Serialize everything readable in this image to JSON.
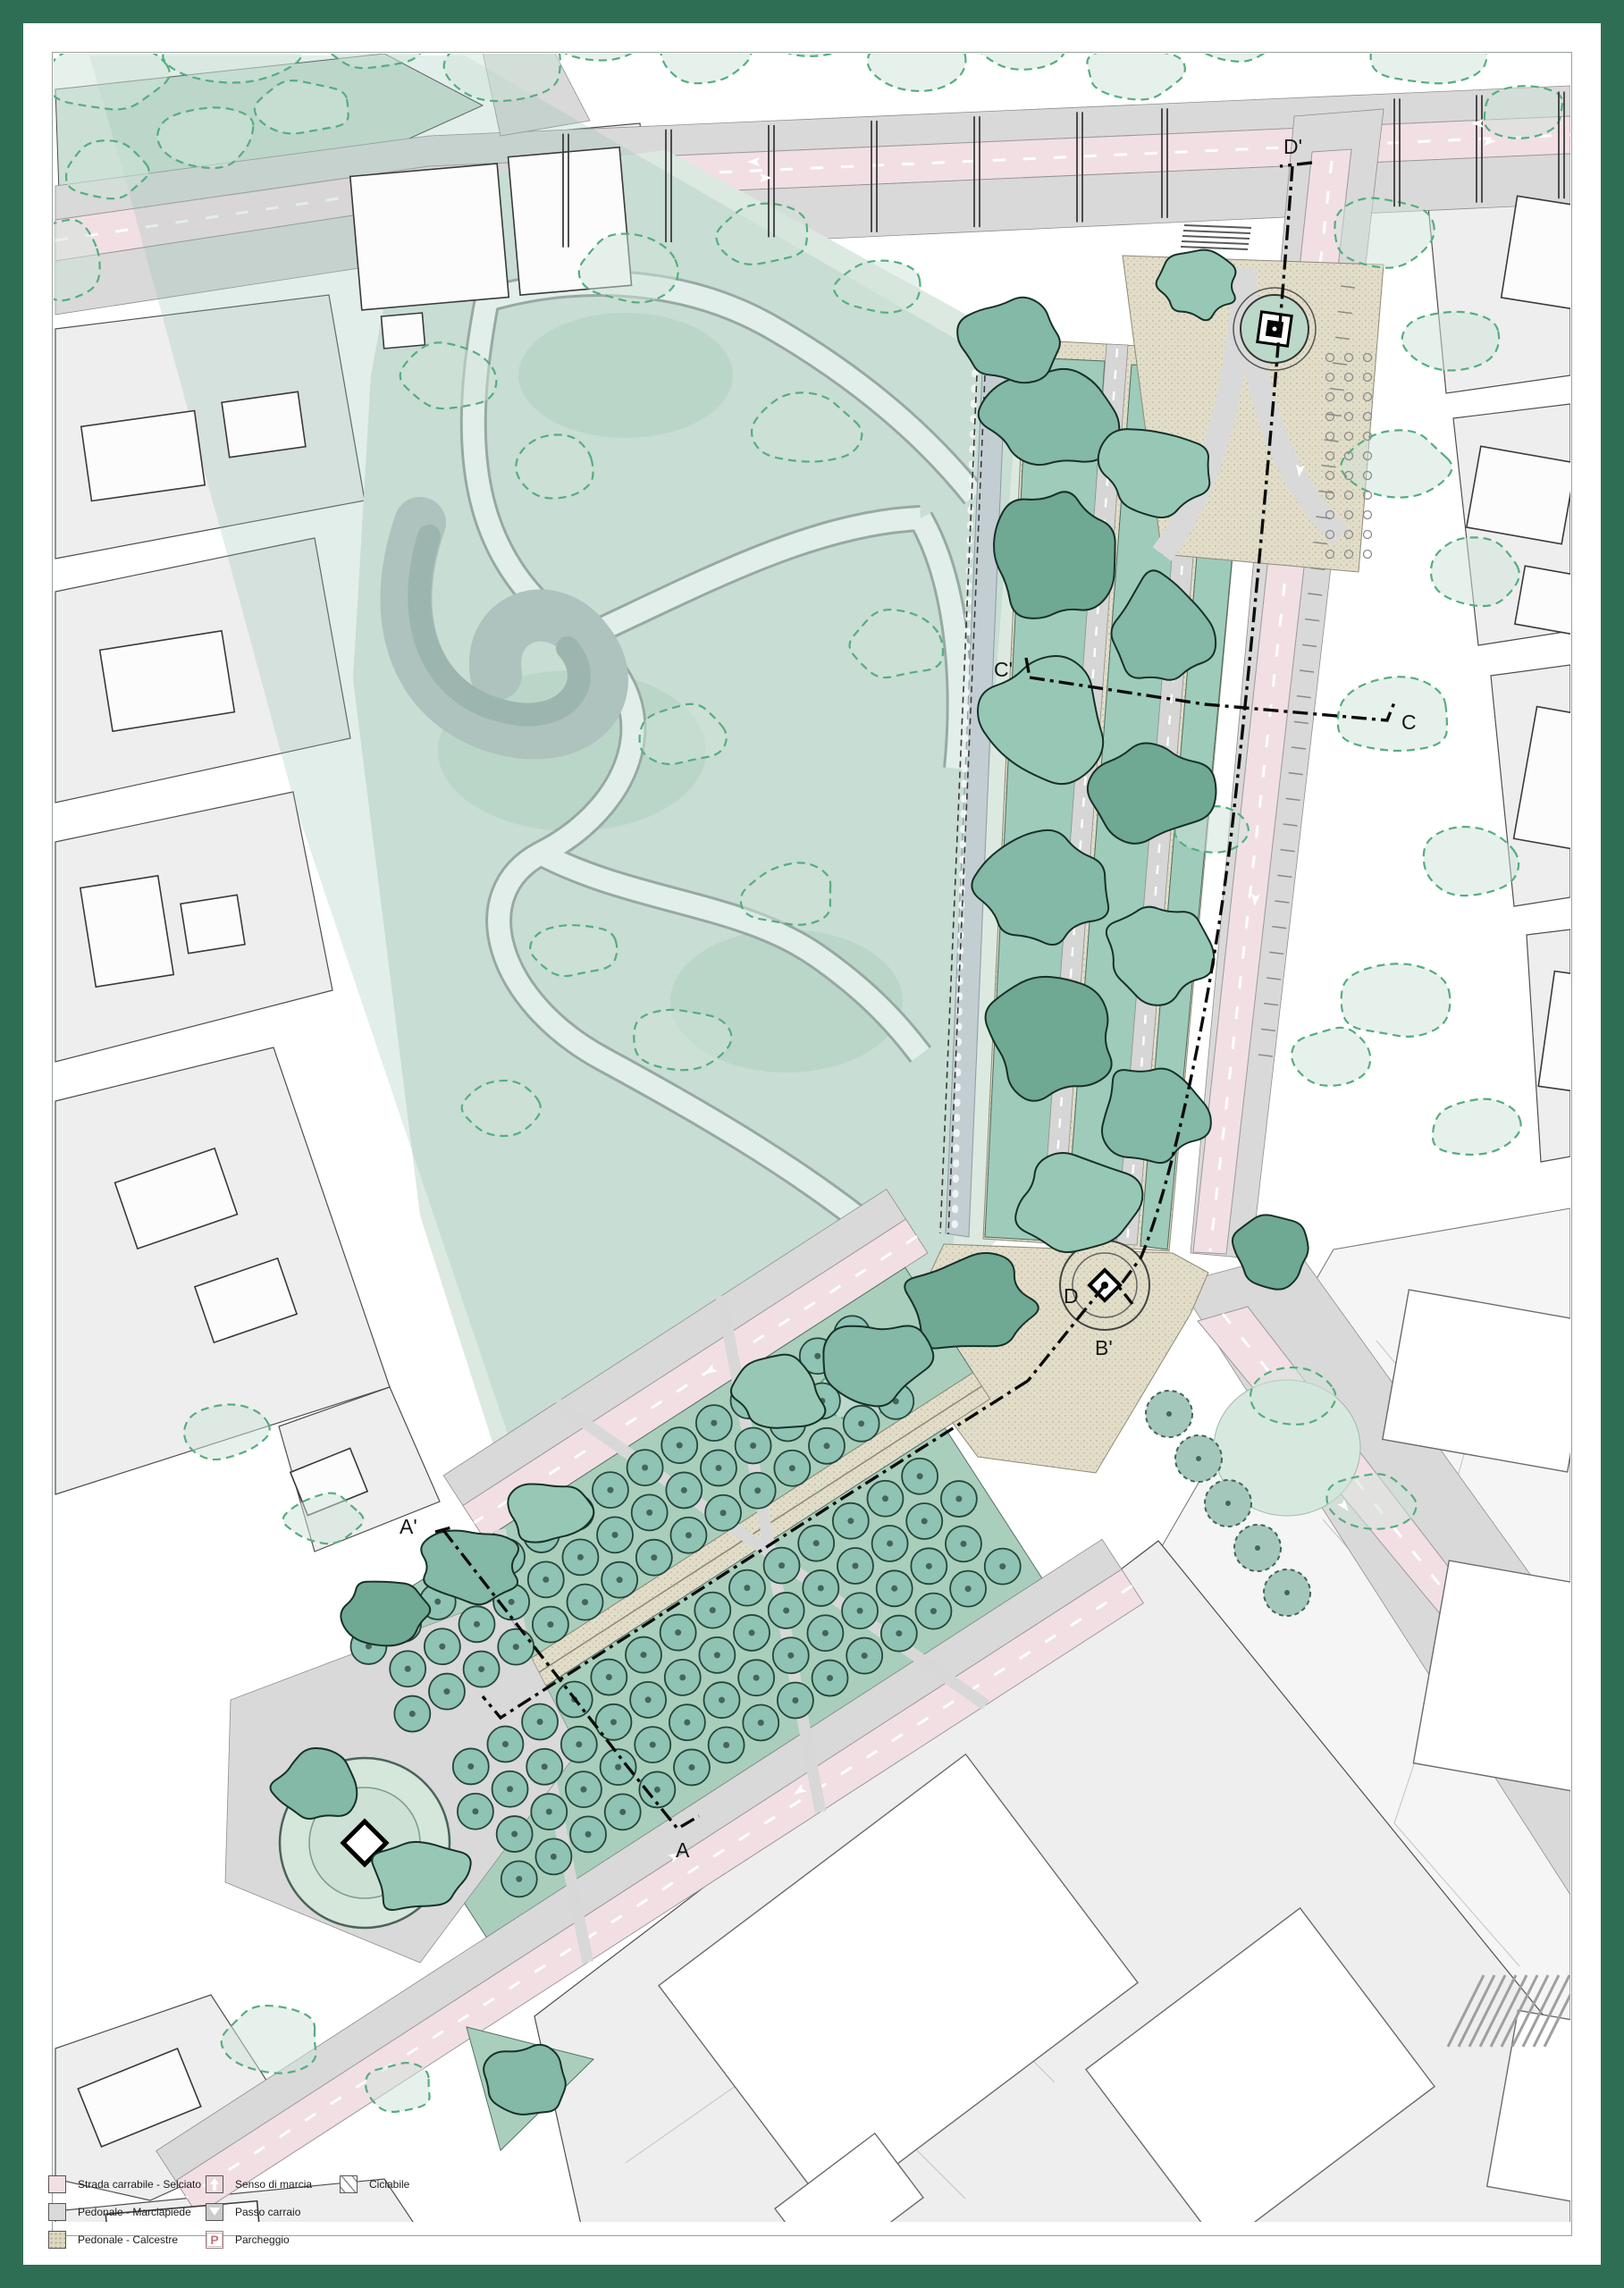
{
  "palette": {
    "border_green": "#2e6e55",
    "road_pink": "#f2dfe4",
    "sidewalk_gray": "#d9d9d9",
    "calcestre": "#e2ddc9",
    "lawn_green": "#a9cfbc",
    "park_fill": "#dce9e1",
    "canopy_dark": "#6fa893",
    "canopy_mid": "#83b9a6",
    "canopy_light": "#97c8b6",
    "existing_tree_fill": "#cfe4d9",
    "existing_tree_stroke": "#54ae7e",
    "water_gray": "#b9c4c4",
    "block_gray": "#eeeeee",
    "parking_letter": "#c0737f"
  },
  "legend": {
    "items": [
      {
        "label": "Strada carrabile - Selciato",
        "swatch": "road-pink"
      },
      {
        "label": "Pedonale - Marciapiede",
        "swatch": "sidewalk-gray"
      },
      {
        "label": "Pedonale - Calcestre",
        "swatch": "calcestre-beige"
      },
      {
        "label": "Senso di marcia",
        "swatch": "direction-arrow",
        "icon": "up-arrow"
      },
      {
        "label": "Passo carraio",
        "swatch": "driveway-triangle",
        "icon": "triangle"
      },
      {
        "label": "Parcheggio",
        "swatch": "parking",
        "icon_letter": "P"
      },
      {
        "label": "Ciclabile",
        "swatch": "bike-lane"
      }
    ]
  },
  "sections": [
    {
      "id": "D-prime",
      "label": "D'"
    },
    {
      "id": "C-prime",
      "label": "C'"
    },
    {
      "id": "C",
      "label": "C"
    },
    {
      "id": "D",
      "label": "D"
    },
    {
      "id": "B-prime",
      "label": "B'"
    },
    {
      "id": "A-prime",
      "label": "A'"
    },
    {
      "id": "A",
      "label": "A"
    }
  ]
}
